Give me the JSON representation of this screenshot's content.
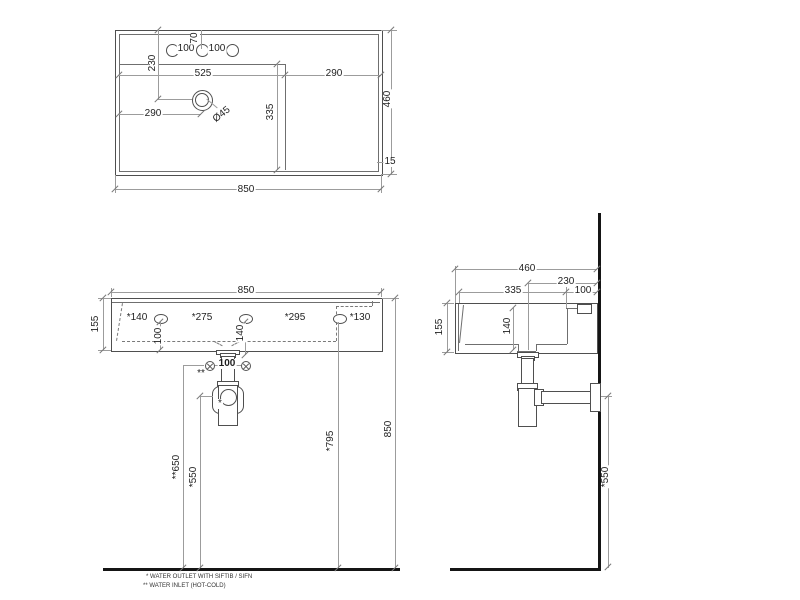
{
  "top_view": {
    "hole_gap_left": "100",
    "hole_offset": "70",
    "hole_gap_right": "100",
    "drain_from_top": "230",
    "basin_width": "525",
    "deck_width": "290",
    "drain_from_left": "290",
    "drain_diameter": "Ø45",
    "basin_length": "335",
    "overall_depth": "460",
    "rim": "15",
    "overall_width": "850"
  },
  "front_view": {
    "overall_width": "850",
    "height": "155",
    "hole1": "*140",
    "hole2": "*275",
    "hole3": "*295",
    "hole4": "*130",
    "hole_drop": "100",
    "drain_drop": "140",
    "inlet_gap": "100",
    "inlet_mark": "**",
    "outlet_mark": "*",
    "inlet_height": "**650",
    "outlet_height": "*550",
    "hole_height": "*795",
    "mount_height": "850"
  },
  "side_view": {
    "overall_depth": "460",
    "drain_from_wall": "230",
    "basin_inner": "335",
    "deck_width": "100",
    "height": "155",
    "inner_depth": "140",
    "outlet_height": "*550"
  },
  "icons": {
    "water_inlet": "circled-x"
  },
  "notes": {
    "outlet": "*  WATER OUTLET WITH SIFTIB / SIFN",
    "inlet": "** WATER INLET  (HOT-COLD)"
  }
}
